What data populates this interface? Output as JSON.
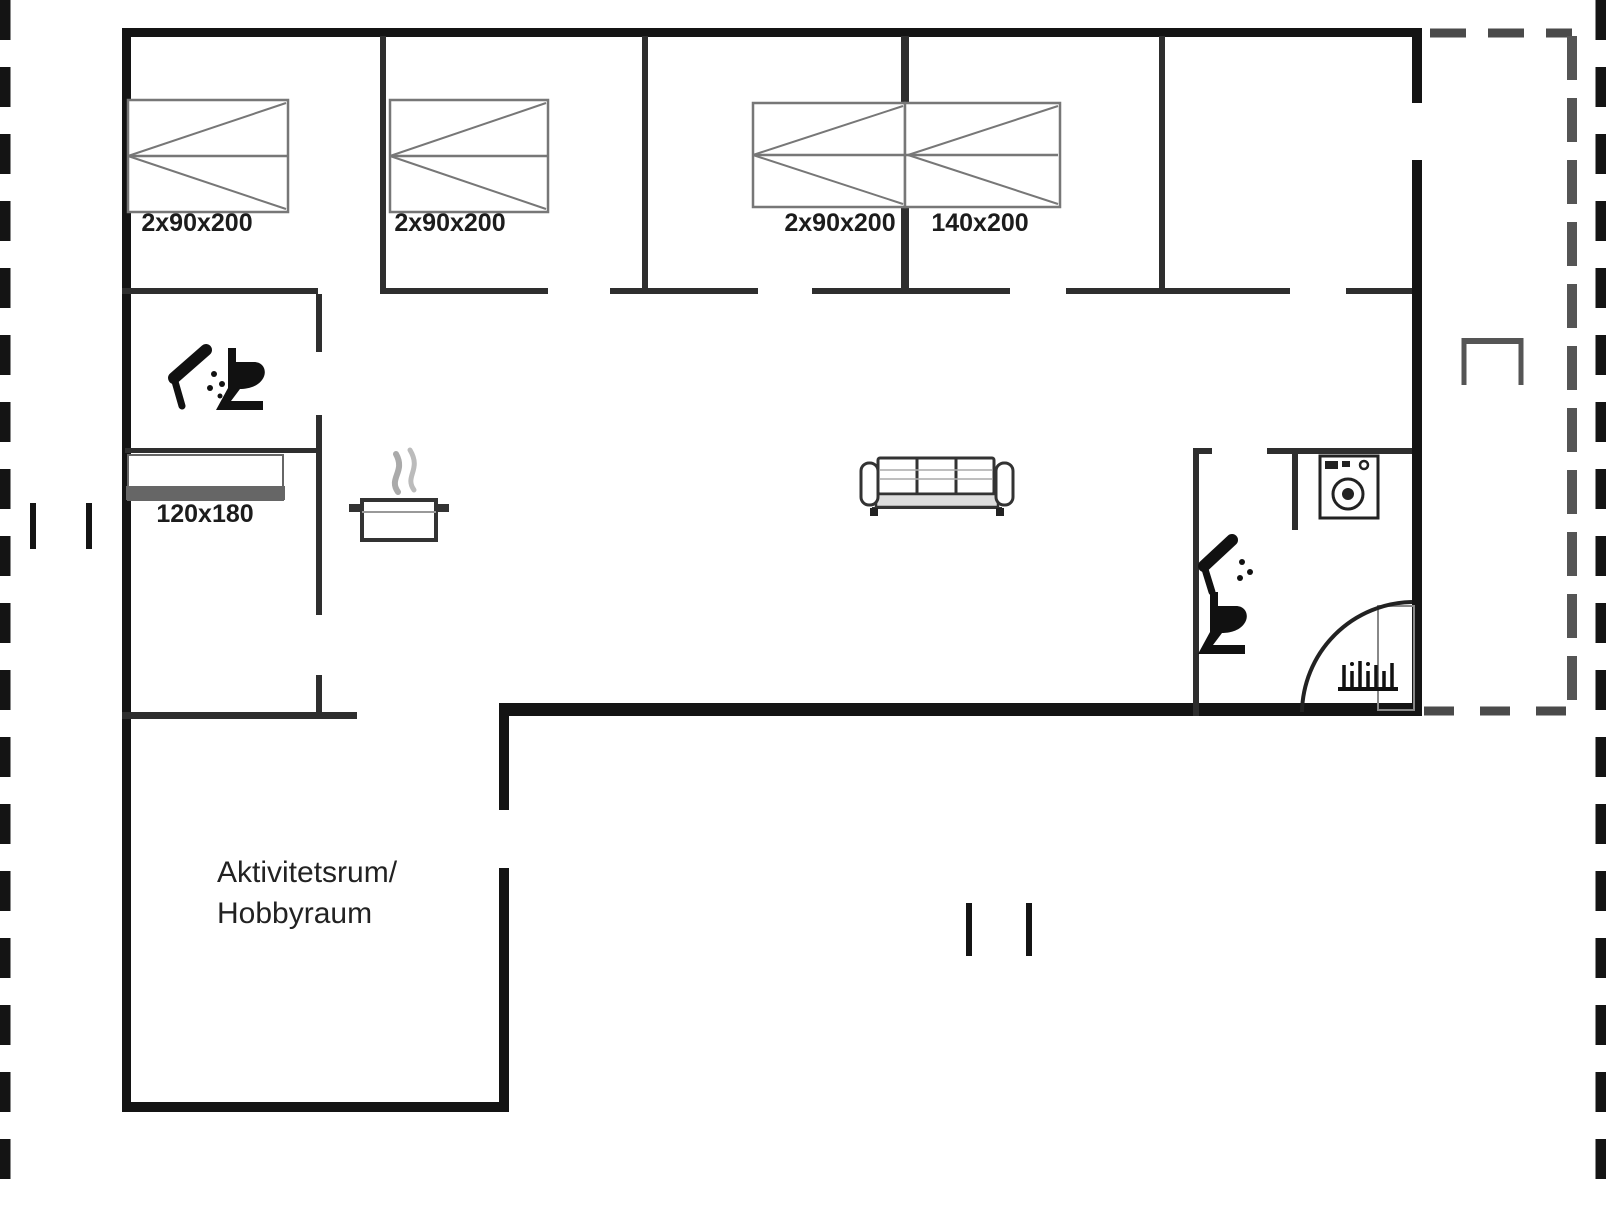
{
  "plan": {
    "type": "floor-plan",
    "bed_labels": [
      "2x90x200",
      "2x90x200",
      "2x90x200",
      "140x200",
      "120x180"
    ],
    "room_labels": {
      "activity_line1": "Aktivitetsrum/",
      "activity_line2": "Hobbyraum"
    },
    "icons": [
      "shower-icon-bathroom-left",
      "toilet-icon-bathroom-left",
      "cooking-pot-icon-kitchen",
      "sofa-icon-living-room",
      "washing-machine-icon-utility",
      "shower-icon-bathroom-right",
      "toilet-icon-bathroom-right",
      "door-swing-arc",
      "terrace-grill-bracket",
      "illegible-text-mark"
    ],
    "colors": {
      "outer_wall": "#141414",
      "inner_wall": "#2e2e2e",
      "furniture_line": "#777777",
      "terrace_dash": "#4a4a4a",
      "background": "#ffffff",
      "text": "#1c1c1c"
    }
  }
}
